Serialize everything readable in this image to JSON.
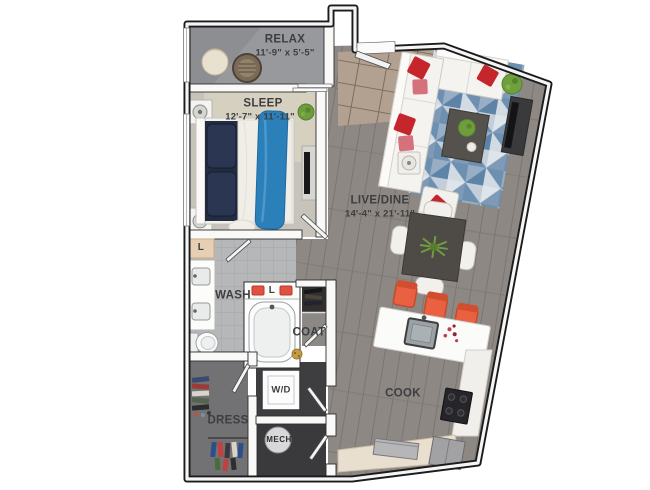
{
  "floorplan": {
    "rooms": {
      "relax": {
        "label": "RELAX",
        "dimensions": "11'-9\" x 5'-5\""
      },
      "sleep": {
        "label": "SLEEP",
        "dimensions": "12'-7\" x 11'-11\""
      },
      "live_dine": {
        "label": "LIVE/DINE",
        "dimensions": "14'-4\" x 21'-11\""
      },
      "wash": {
        "label": "WASH"
      },
      "coat": {
        "label": "COAT"
      },
      "cook": {
        "label": "COOK"
      },
      "dress": {
        "label": "DRESS"
      },
      "washer_dryer": {
        "label": "W/D"
      },
      "mechanical": {
        "label": "MECH"
      },
      "linen_closet": {
        "label": "L"
      },
      "linen_shelf": {
        "label": "L"
      }
    },
    "colors": {
      "wall_black": "#1b1b1b",
      "accent_red": "#c5262c",
      "accent_rose": "#d4717c",
      "rug_blue": "#7e9ab6",
      "throw_blue": "#2b80ba",
      "stool_orange": "#ea6141",
      "towel_red": "#e0513f",
      "plant_green": "#6f9c3f",
      "wood_gray": "#8d8883",
      "balcony_gray": "#98999c"
    }
  }
}
